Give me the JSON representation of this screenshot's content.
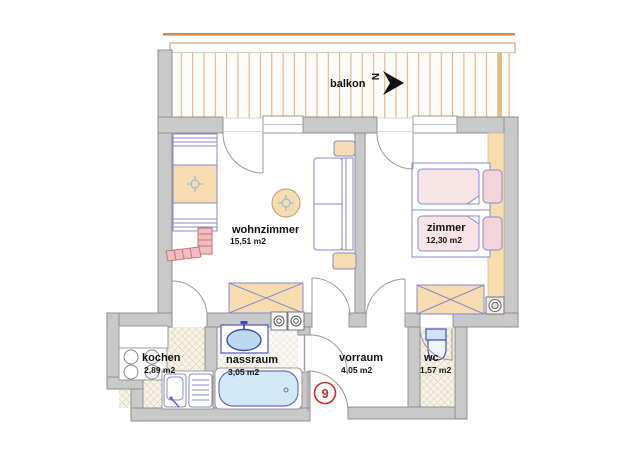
{
  "plan": {
    "title": "apartment floor plan",
    "balcony": {
      "label": "balkon",
      "north_letter": "N"
    },
    "rooms": [
      {
        "id": "wohnzimmer",
        "name": "wohnzimmer",
        "area": "15,51 m2"
      },
      {
        "id": "zimmer",
        "name": "zimmer",
        "area": "12,30 m2"
      },
      {
        "id": "kochen",
        "name": "kochen",
        "area": "2,89 m2"
      },
      {
        "id": "nassraum",
        "name": "nassraum",
        "area": "3,05 m2"
      },
      {
        "id": "vorraum",
        "name": "vorraum",
        "area": "4,05 m2"
      },
      {
        "id": "wc",
        "name": "wc",
        "area": "1,57 m2"
      }
    ],
    "apartment_number": "9",
    "icons": {
      "north-arrow-icon": "black arrow pointing east beside rotated N",
      "lamp-symbol-icon": "crosshair circle ceiling lamp marker",
      "washing-machine-icon": "square with concentric circles",
      "stove-icon": "four burner circles",
      "sink-icon": "kitchen sink with tap and drainboard",
      "washbasin-icon": "oval basin with tap",
      "bathtub-icon": "rounded tub",
      "toilet-icon": "cistern and bowl"
    },
    "colors": {
      "wall_fill": "#c9c9c9",
      "wall_stroke": "#8a8a8a",
      "furniture_outline": "#8888cc",
      "wood_tan": "#f6dcae",
      "mattress_pink": "#f8e4e4",
      "pillow_pink": "#f3d5d9",
      "brick_pink": "#f2bdbf",
      "brick_stroke": "#c4737f",
      "water_blue": "#cfe8f7",
      "basin_blue": "#bcd9f2",
      "deck_line": "#d9ae7e",
      "railing_tan": "#c89058",
      "hatch_bg": "#f8f3e9",
      "hatch_line": "#ded0ae",
      "number_red": "#d42a2a",
      "text_black": "#111111"
    }
  }
}
